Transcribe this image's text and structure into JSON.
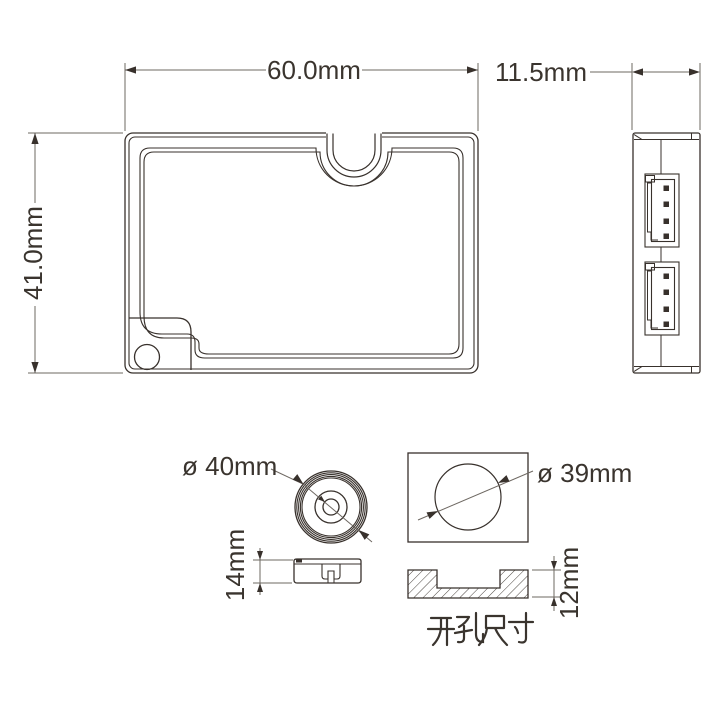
{
  "page": {
    "background": "#ffffff"
  },
  "drawing": {
    "module": {
      "front_width_label": "60.0mm",
      "front_height_label": "41.0mm",
      "side_depth_label": "11.5mm"
    },
    "knob": {
      "top_diameter_label": "ø 40mm",
      "side_height_label": "14mm"
    },
    "cutout": {
      "hole_diameter_label": "ø 39mm",
      "section_depth_label": "12mm",
      "caption": "开孔尺寸"
    },
    "colors": {
      "part_line": "#38312c",
      "dimension_line": "#6e6862",
      "text": "#3a342e",
      "background": "#ffffff"
    }
  }
}
